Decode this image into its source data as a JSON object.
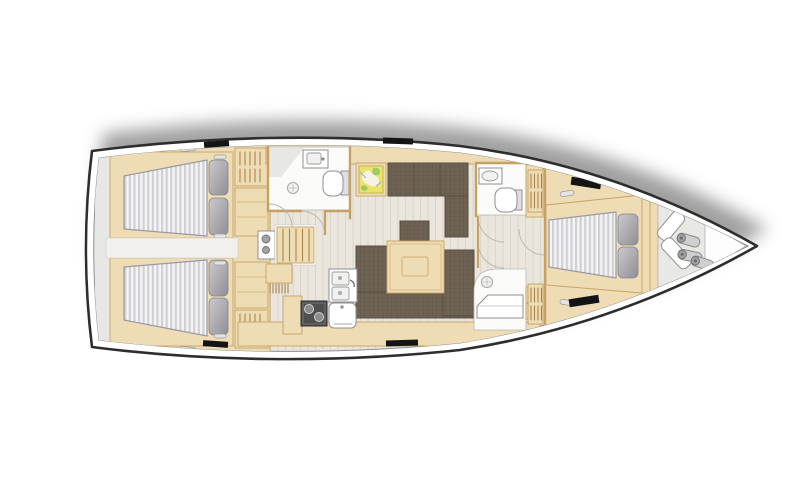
{
  "meta": {
    "title": "Sailing yacht interior layout plan, top view, bow pointing right",
    "orientation": {
      "bow": "right",
      "stern": "left"
    }
  },
  "colors": {
    "hull_outline": "#2d2d2d",
    "hull_white": "#ffffff",
    "shadow": "#878787",
    "floor": "#eae6dd",
    "floor_line": "#dcd6c9",
    "wood": "#eedcb5",
    "wood_edge": "#c7a163",
    "wood_line": "#d9bd85",
    "upholstery": "#6e6254",
    "upholstery_dark": "#59503f",
    "mattress_light": "#f4f4f5",
    "mattress_dark": "#cfcfd4",
    "mattress_edge": "#9a9aa1",
    "pillow_light": "#c6c6ca",
    "pillow_dark": "#8f8f95",
    "fixture_fill": "#ffffff",
    "fixture_outline": "#8f8f8f",
    "room_floor": "#fbfbfa",
    "room_wall": "#b9b9b3",
    "counter_gray": "#e7e7e5",
    "stove_dark": "#4f4f4f",
    "hatch": "#141414",
    "locker_floor": "#e8e8e5",
    "map_bg": "#ece269",
    "map_green": "#9ecb62",
    "map_blue": "#7fb2d9",
    "map_white": "#f7f3e2"
  },
  "regions": {
    "hull": "Yacht hull, bow right and stern left",
    "shadow": "Soft drop shadow above hull",
    "stern_platform": "Stern transom platform",
    "aft_cabin_port": "Aft double cabin, port side, with striped mattress and two pillows",
    "aft_cabin_starboard": "Aft double cabin, starboard side, with striped mattress and two pillows",
    "companionway": "Companionway steps with engine box",
    "aft_head": "Aft head with washbasin, toilet and shower drain",
    "nav_station": "Chart table with nautical map",
    "saloon": "Saloon with U-shaped settee and folding table",
    "galley": "Galley with twin sinks, two-burner stove and oven",
    "forward_head": "Forward head with washbasin and toilet",
    "forward_shower": "Separate shower stall with seat",
    "forward_cabin": "Forward double cabin with V-berth",
    "bow_locker": "Bow sail locker with fenders and bags",
    "deck_hatches": "Black deck hatches along hull sides"
  },
  "inventory": {
    "cabins": 3,
    "double_berths": 3,
    "pillows_per_berth": 2,
    "wet_rooms": 3,
    "galley_sinks": 2,
    "stove_burners": 2,
    "fenders": 3,
    "sail_bags": 2,
    "deck_hatches": 6,
    "hanging_lockers": 4
  }
}
